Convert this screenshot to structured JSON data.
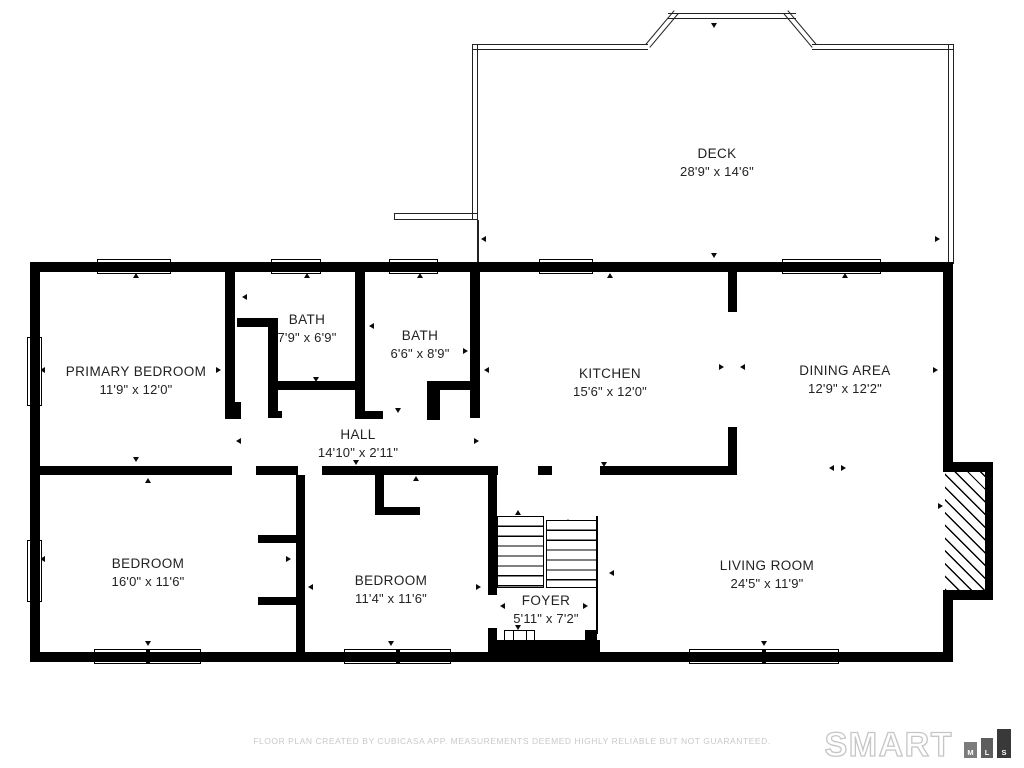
{
  "plan": {
    "rooms": [
      {
        "name": "DECK",
        "dims": "28'9\" x 14'6\""
      },
      {
        "name": "PRIMARY BEDROOM",
        "dims": "11'9\" x 12'0\""
      },
      {
        "name": "BATH",
        "dims": "7'9\" x 6'9\""
      },
      {
        "name": "BATH",
        "dims": "6'6\" x 8'9\""
      },
      {
        "name": "KITCHEN",
        "dims": "15'6\" x 12'0\""
      },
      {
        "name": "DINING AREA",
        "dims": "12'9\" x 12'2\""
      },
      {
        "name": "HALL",
        "dims": "14'10\" x 2'11\""
      },
      {
        "name": "BEDROOM",
        "dims": "16'0\" x 11'6\""
      },
      {
        "name": "BEDROOM",
        "dims": "11'4\" x 11'6\""
      },
      {
        "name": "FOYER",
        "dims": "5'11\" x 7'2\""
      },
      {
        "name": "LIVING ROOM",
        "dims": "24'5\" x 11'9\""
      }
    ]
  },
  "footer": {
    "disclaimer": "FLOOR PLAN CREATED BY CUBICASA APP. MEASUREMENTS DEEMED HIGHLY RELIABLE BUT NOT GUARANTEED."
  },
  "brand": {
    "word": "SMART",
    "blocks": [
      "M",
      "L",
      "S"
    ]
  },
  "colors": {
    "wall": "#000000",
    "deck_line": "#222222",
    "label": "#222222",
    "disclaimer": "#c9c9c9",
    "logo_outline": "#c6c6c6",
    "mls_bars": [
      "#7c7c7c",
      "#5d5d5d",
      "#393939"
    ]
  }
}
